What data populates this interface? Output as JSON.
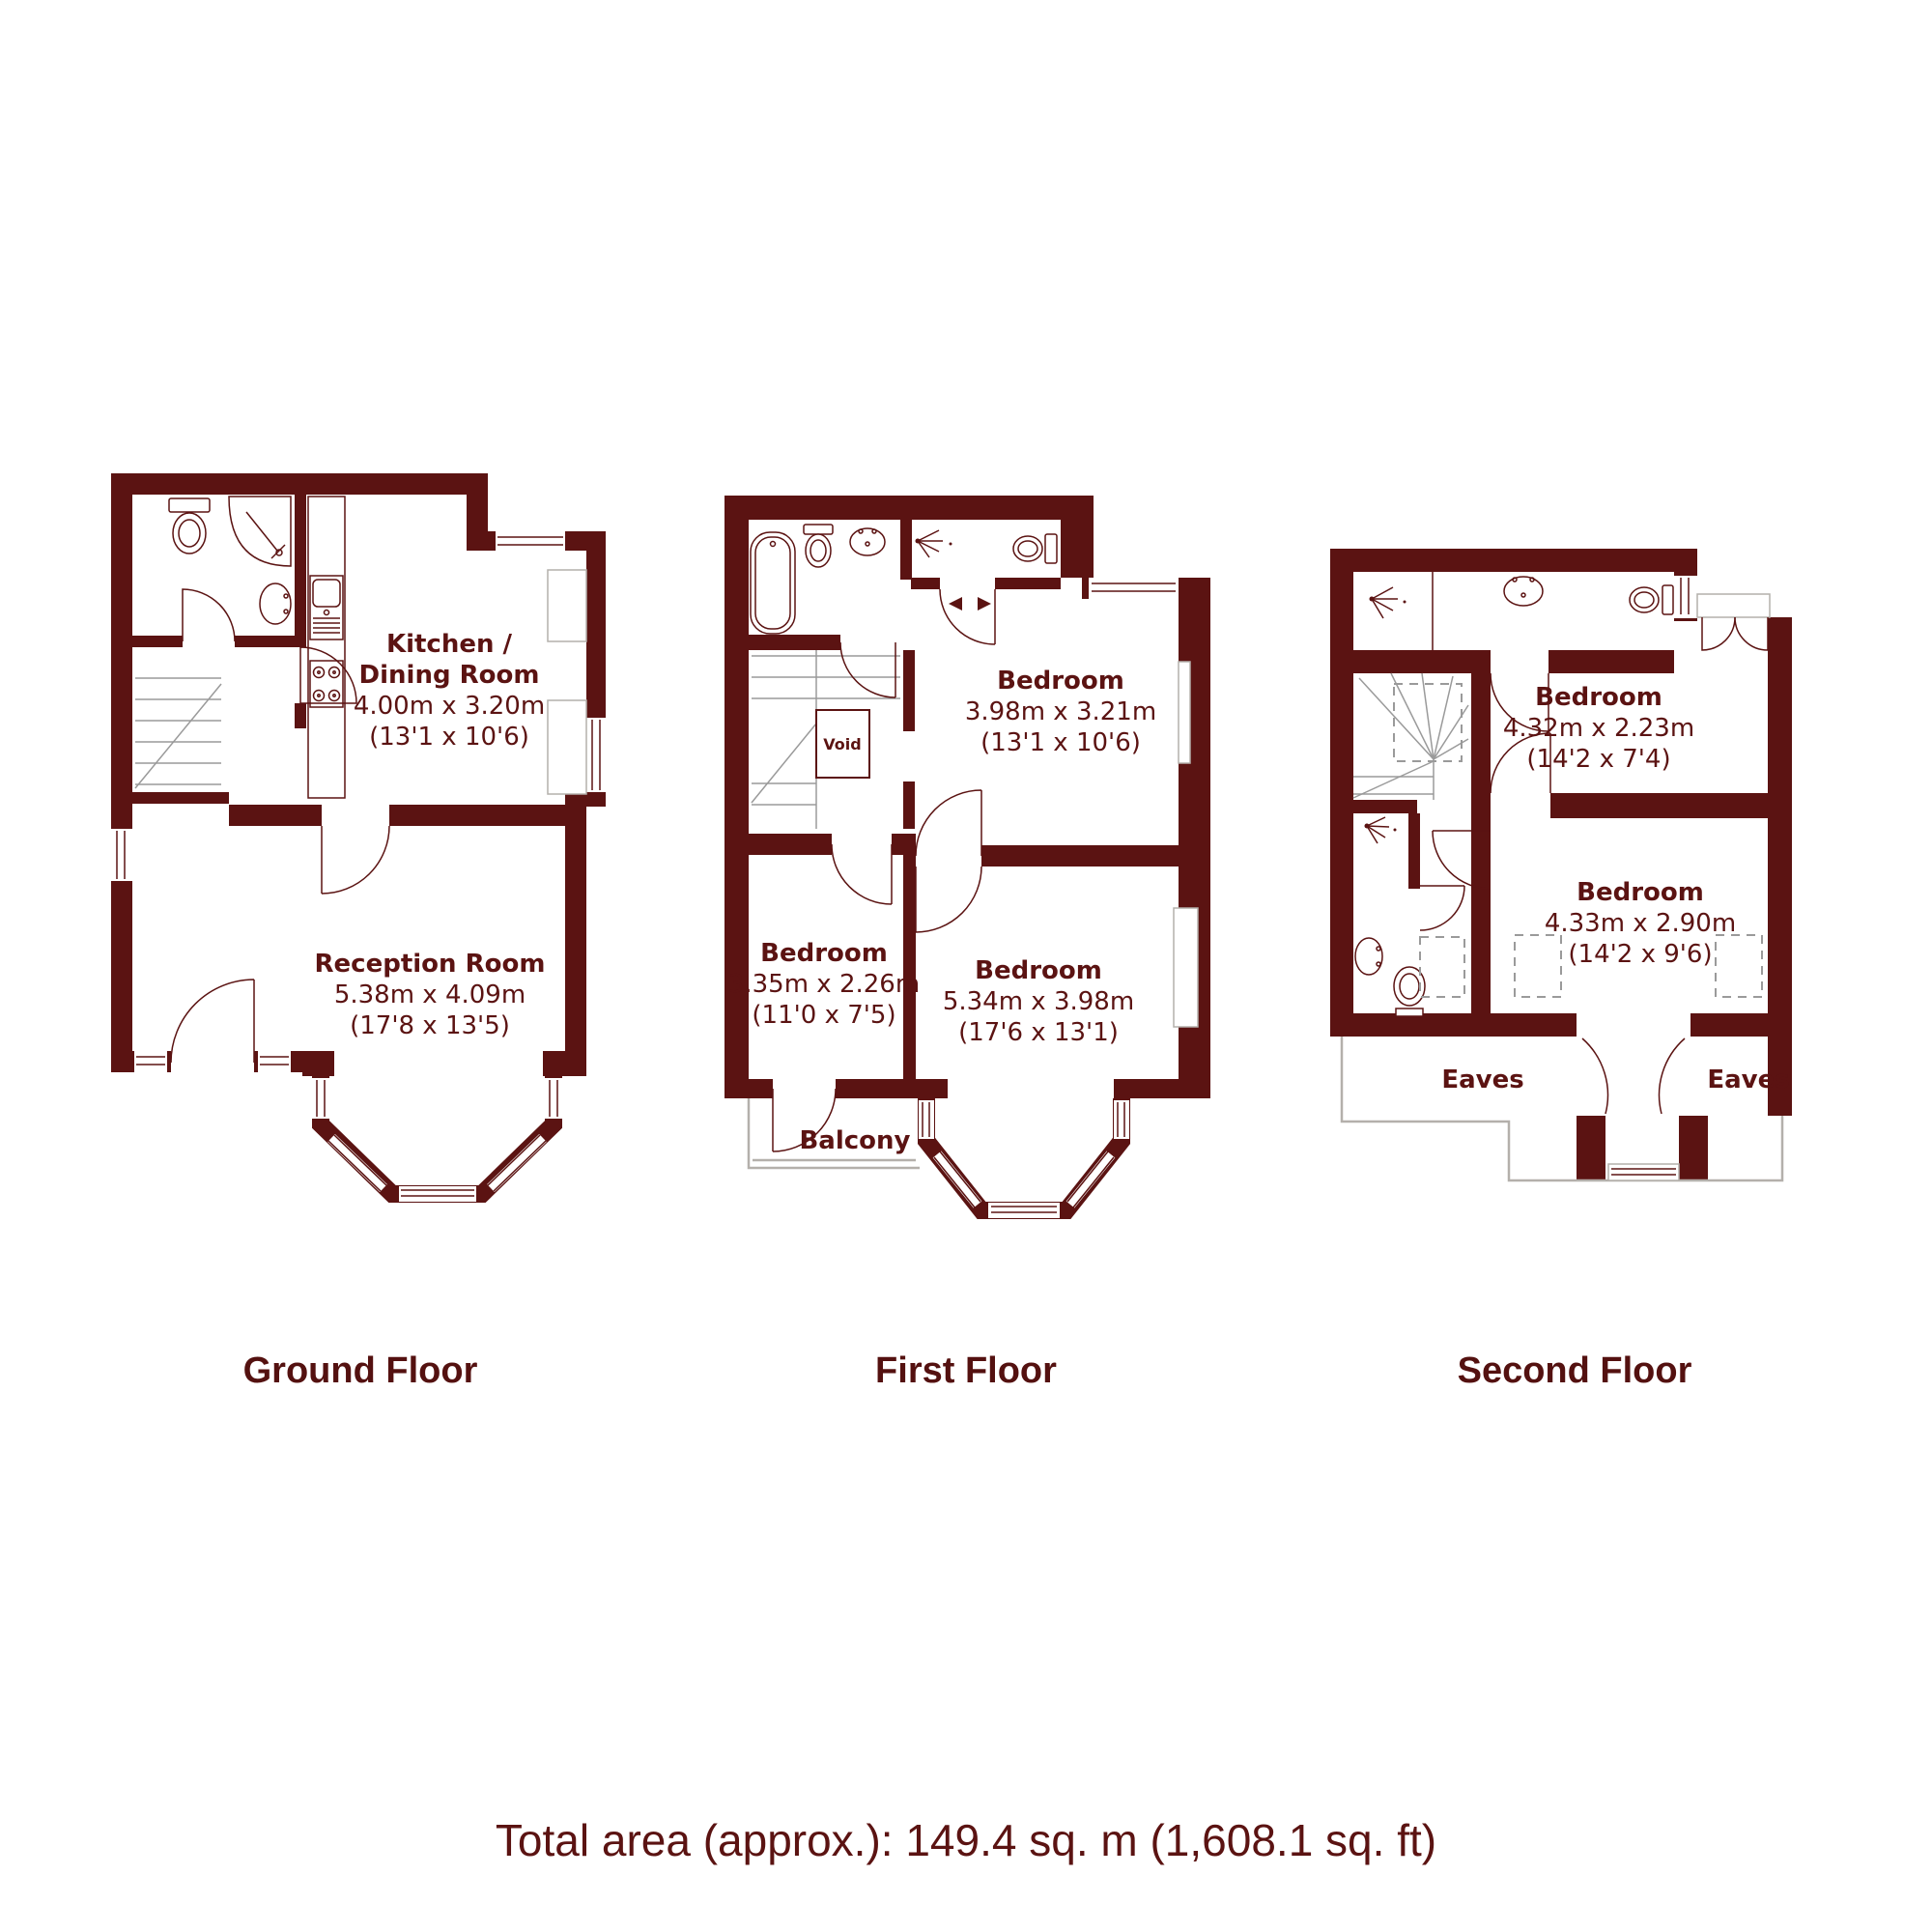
{
  "meta": {
    "wall_color": "#5b1312",
    "text_color": "#5b1312",
    "accent_gray": "#b4b0ab",
    "background": "#ffffff"
  },
  "floors": {
    "ground": {
      "title": "Ground Floor",
      "rooms": {
        "kitchen": {
          "line1": "Kitchen /",
          "line2": "Dining Room",
          "metric": "4.00m x 3.20m",
          "imperial": "(13'1 x 10'6)"
        },
        "reception": {
          "name": "Reception Room",
          "metric": "5.38m x 4.09m",
          "imperial": "(17'8 x 13'5)"
        }
      },
      "fixtures": [
        "toilet",
        "corner-shower",
        "basin",
        "kitchen-sink",
        "hob",
        "stairs",
        "bay-window",
        "front-door"
      ]
    },
    "first": {
      "title": "First Floor",
      "rooms": {
        "bedroom_rear": {
          "name": "Bedroom",
          "metric": "3.98m x 3.21m",
          "imperial": "(13'1 x 10'6)"
        },
        "bedroom_small": {
          "name": "Bedroom",
          "metric": "3.35m x 2.26m",
          "imperial": "(11'0 x 7'5)"
        },
        "bedroom_front": {
          "name": "Bedroom",
          "metric": "5.34m x 3.98m",
          "imperial": "(17'6 x 13'1)"
        }
      },
      "labels": {
        "void": "Void",
        "balcony": "Balcony"
      },
      "fixtures": [
        "bath",
        "toilet",
        "basin",
        "shower",
        "wc-toilet",
        "stairs",
        "bay-window",
        "balcony"
      ]
    },
    "second": {
      "title": "Second Floor",
      "rooms": {
        "bedroom_rear": {
          "name": "Bedroom",
          "metric": "4.32m x 2.23m",
          "imperial": "(14'2 x 7'4)"
        },
        "bedroom_front": {
          "name": "Bedroom",
          "metric": "4.33m x 2.90m",
          "imperial": "(14'2 x 9'6)"
        }
      },
      "labels": {
        "eaves_left": "Eaves",
        "eaves_right": "Eaves"
      },
      "fixtures": [
        "shower",
        "basin",
        "toilet",
        "stairs",
        "shower-cubicle",
        "bathroom-basin",
        "bathroom-toilet",
        "french-doors",
        "dormer-window",
        "skylights"
      ]
    }
  },
  "footer": {
    "total_area": "Total area (approx.): 149.4 sq. m (1,608.1 sq. ft)"
  }
}
